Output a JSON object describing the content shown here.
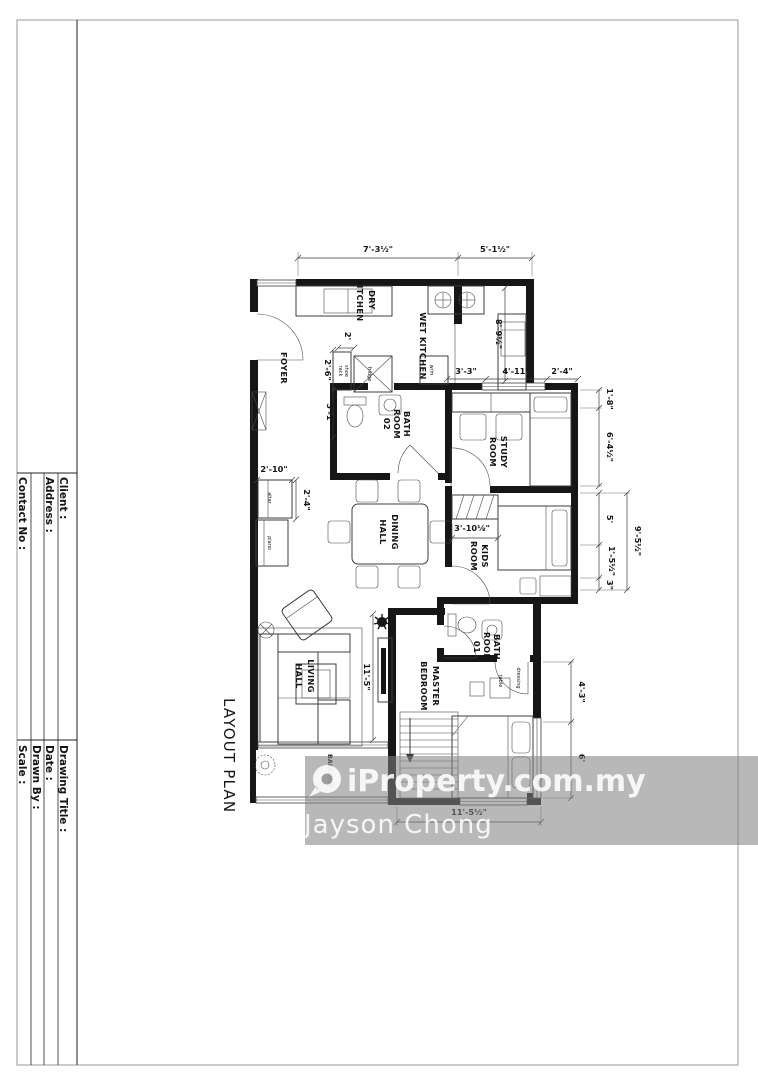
{
  "sheet": {
    "plan_title": "LAYOUT PLAN",
    "title_block": {
      "client": "Client :",
      "address": "Address :",
      "contact": "Contact No :",
      "drawing_title": "Drawing Title :",
      "date": "Date :",
      "drawn_by": "Drawn By :",
      "scale": "Scale :"
    }
  },
  "rooms": {
    "foyer": "FOYER",
    "dry_kitchen_1": "DRY",
    "dry_kitchen_2": "KITCHEN",
    "wet_kitchen": "WET KITCHEN",
    "bath2_1": "BATH",
    "bath2_2": "ROOM",
    "bath2_3": "02",
    "study_1": "STUDY",
    "study_2": "ROOM",
    "dining_1": "DINING",
    "dining_2": "HALL",
    "kids_1": "KIDS",
    "kids_2": "ROOM",
    "living_1": "LIVING",
    "living_2": "HALL",
    "master_1": "MASTER",
    "master_2": "BEDROOM",
    "bath1_1": "BATH",
    "bath1_2": "ROOM",
    "bath1_3": "01",
    "balcony": "BALCONY"
  },
  "furniture": {
    "shoe_1": "shoe",
    "shoe_2": "rack",
    "fridge": "fridge",
    "wm": "w/m",
    "altar": "altar",
    "piano": "piano",
    "dressing_1": "dressing",
    "dressing_2": "table"
  },
  "dimensions": {
    "top_left": "7'-3½\"",
    "top_right": "5'-1½\"",
    "kitchen_depth": "8'-9½\"",
    "seg_3_3": "3'-3\"",
    "seg_4_11": "4'-11\"",
    "seg_2_4": "2'-4\"",
    "right_1_8": "1'-8\"",
    "right_6_4": "6'-4½\"",
    "right_5": "5'",
    "right_1_5": "1'-5½\"",
    "right_3": "3\"",
    "right_9_5": "9'-5½\"",
    "dine_2_10": "2'-10\"",
    "altar_2_4": "2'-4\"",
    "foyer_2": "2'",
    "foyer_2_6": "2'-6\"",
    "foyer_5_1": "5'-1\"",
    "kids_3_10": "3'-10⅛\"",
    "living_11_5": "11'-5\"",
    "master_4_3": "4'-3\"",
    "master_6": "6'",
    "bottom_11_5": "11'-5½\""
  },
  "watermark": {
    "brand": "iProperty.com.my",
    "agent": "Jayson Chong"
  }
}
